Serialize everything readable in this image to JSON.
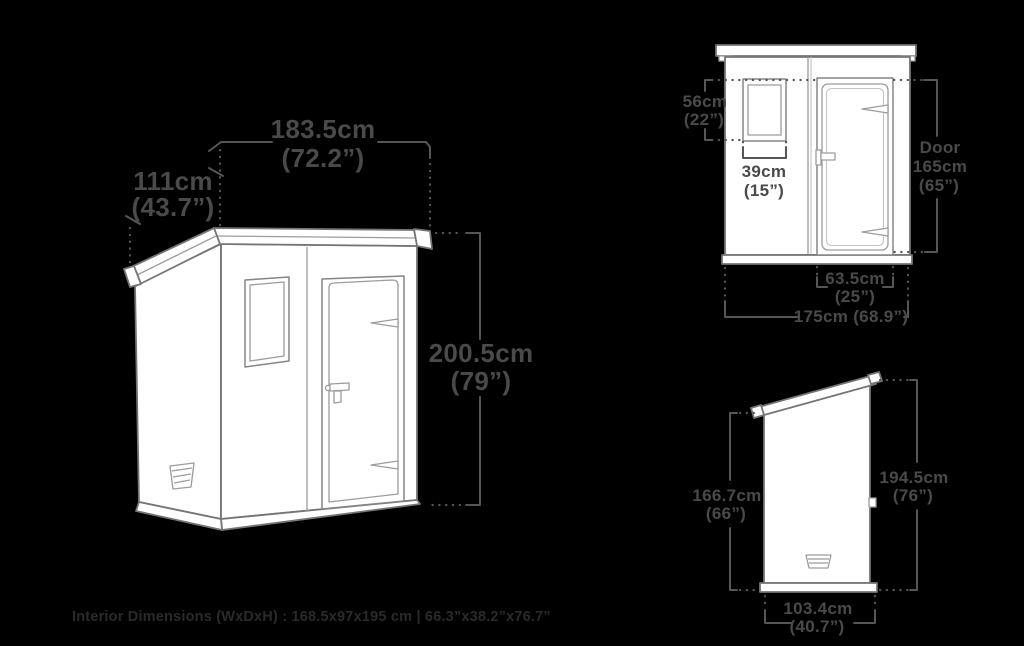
{
  "canvas": {
    "background": "#000000"
  },
  "colors": {
    "dimension_text": "#4a4a4a",
    "dimension_line": "#565656",
    "shed_outline": "#757575",
    "shed_detail": "#9c9c9c",
    "shed_fill": "#ffffff",
    "footer_text": "#2a2a2a"
  },
  "perspective_view": {
    "width_cm": "183.5cm",
    "width_in": "(72.2”)",
    "depth_cm": "111cm",
    "depth_in": "(43.7”)",
    "height_cm": "200.5cm",
    "height_in": "(79”)"
  },
  "front_view": {
    "window_height_cm": "56cm",
    "window_height_in": "(22”)",
    "window_width_cm": "39cm",
    "window_width_in": "(15”)",
    "door_label": "Door",
    "door_height_cm": "165cm",
    "door_height_in": "(65”)",
    "door_width_cm": "63.5cm",
    "door_width_in": "(25”)",
    "overall_width": "175cm (68.9”)"
  },
  "side_view": {
    "wall_height_cm": "166.7cm",
    "wall_height_in": "(66”)",
    "overall_height_cm": "194.5cm",
    "overall_height_in": "(76”)",
    "depth_cm": "103.4cm",
    "depth_in": "(40.7”)"
  },
  "footer": {
    "interior_dimensions": "Interior Dimensions (WxDxH) : 168.5x97x195 cm | 66.3”x38.2”x76.7”"
  }
}
